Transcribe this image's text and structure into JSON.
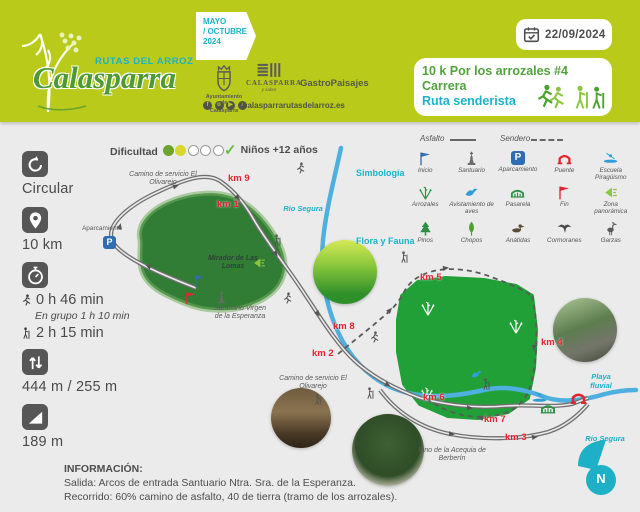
{
  "header": {
    "logo": {
      "subtitle": "RUTAS DEL ARROZ",
      "title": "Calasparra"
    },
    "season": {
      "line1": "MAYO",
      "line2": "/ OCTUBRE",
      "line3": "2024"
    },
    "partners": {
      "ayuntamiento_line1": "Ayuntamiento de",
      "ayuntamiento_line2": "Calasparra",
      "calasparra": "CALASPARRA",
      "calasparra_sub": "y sabor",
      "gastro": "GastroPaisajes",
      "website": "calasparrarutasdelarroz.es"
    },
    "socials": [
      {
        "name": "facebook",
        "glyph": "f"
      },
      {
        "name": "instagram",
        "glyph": "o"
      },
      {
        "name": "youtube",
        "glyph": "▶"
      },
      {
        "name": "tiktok",
        "glyph": "♪"
      }
    ],
    "date": "22/09/2024",
    "event": {
      "line1": "10 k Por los arrozales #4",
      "line2": "Carrera",
      "line3": "Ruta senderista"
    }
  },
  "stats": {
    "type": "Circular",
    "distance": "10 km",
    "time_run": "0 h 46 min",
    "time_group": "En grupo 1 h 10 min",
    "time_walk": "2 h 15 min",
    "elevation_gain": "444 m / 255 m",
    "slope": "189 m"
  },
  "difficulty": {
    "label": "Dificultad",
    "max": 5,
    "filled": [
      "#6da32e",
      "#d8d92c"
    ]
  },
  "kids": {
    "check": "✓",
    "label": "Niños +12 años"
  },
  "legend": {
    "line_types": [
      {
        "label": "Asfalto",
        "style": "solid"
      },
      {
        "label": "Sendero",
        "style": "dashed"
      }
    ],
    "simbologia_label": "Simbología",
    "flora_label": "Flora y Fauna",
    "simbologia": [
      {
        "icon": "start-flag-icon",
        "label": "Inicio"
      },
      {
        "icon": "sanctuary-icon",
        "label": "Santuario"
      },
      {
        "icon": "parking-icon",
        "label": "Aparcamiento"
      },
      {
        "icon": "bridge-icon",
        "label": "Puente"
      },
      {
        "icon": "kayak-school-icon",
        "label": "Escuela Piragüismo"
      },
      {
        "icon": "rice-field-icon",
        "label": "Arrozales"
      },
      {
        "icon": "birdwatching-icon",
        "label": "Avistamiento de aves"
      },
      {
        "icon": "walkway-icon",
        "label": "Pasarela"
      },
      {
        "icon": "finish-flag-icon",
        "label": "Fin"
      },
      {
        "icon": "panoramic-icon",
        "label": "Zona panorámica"
      }
    ],
    "flora_fauna": [
      {
        "icon": "pine-icon",
        "label": "Pinos"
      },
      {
        "icon": "poplar-icon",
        "label": "Chopos"
      },
      {
        "icon": "duck-icon",
        "label": "Anátidas"
      },
      {
        "icon": "cormorant-icon",
        "label": "Cormoranes"
      },
      {
        "icon": "heron-icon",
        "label": "Garzas"
      }
    ]
  },
  "map": {
    "km_markers": [
      "km 9",
      "km 1",
      "km 5",
      "km 8",
      "km 2",
      "km 4",
      "km 6",
      "km 7",
      "km 3"
    ],
    "labels": {
      "camino_servicio_1": "Camino de servicio El Olivarejo",
      "camino_servicio_2": "Camino de servicio El Olivarejo",
      "aparcamiento": "Aparcamiento",
      "mirador": "Mirador de Las Lomas",
      "santuario": "Santuario Virgen de la Esperanza",
      "rio_segura_1": "Río Segura",
      "rio_segura_2": "Río Segura",
      "playa_fluvial": "Playa fluvial",
      "pino_acequia": "Pino de la Acequia de Berberín"
    },
    "parking_letter": "P",
    "north_letter": "N"
  },
  "info": {
    "title": "INFORMACIÓN:",
    "line1": "Salida: Arcos de entrada Santuario Ntra. Sra. de la Esperanza.",
    "line2": "Recorrido: 60% camino de asfalto, 40 de tierra (tramo de los arrozales)."
  }
}
